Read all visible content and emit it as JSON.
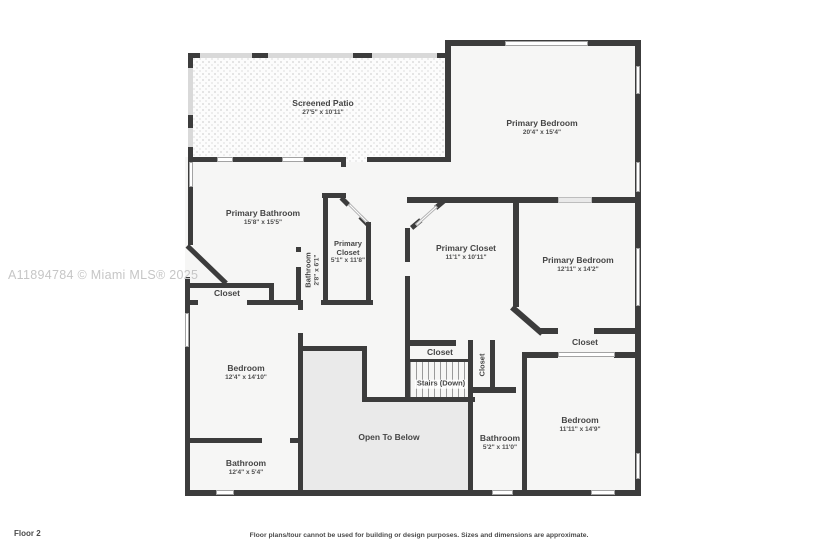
{
  "meta": {
    "watermark": "A11894784 © Miami MLS® 2025",
    "floor_label": "Floor 2",
    "disclaimer": "Floor plans/tour cannot be used for building or design purposes. Sizes and dimensions are approximate."
  },
  "colors": {
    "wall": "#3c3c3c",
    "room_fill": "#f6f6f5",
    "open_to_below_fill": "#eaeaea",
    "screen_wall": "#d9d9d9",
    "label_text": "#454545",
    "watermark_text": "#c6c6c6"
  },
  "rooms": {
    "screened_patio": {
      "name": "Screened Patio",
      "dims": "27'5\" x 10'11\""
    },
    "primary_bedroom_1": {
      "name": "Primary Bedroom",
      "dims": "20'4\" x 15'4\""
    },
    "primary_bathroom": {
      "name": "Primary Bathroom",
      "dims": "15'8\" x 15'5\""
    },
    "bathroom_small": {
      "name": "Bathroom",
      "dims": "2'8\" x 6'1\""
    },
    "primary_closet_small": {
      "name": "Primary Closet",
      "dims": "5'1\" x 11'8\""
    },
    "primary_closet_large": {
      "name": "Primary Closet",
      "dims": "11'1\" x 10'11\""
    },
    "primary_bedroom_2": {
      "name": "Primary Bedroom",
      "dims": "12'11\" x 14'2\""
    },
    "closet_left": {
      "name": "Closet"
    },
    "bedroom_left": {
      "name": "Bedroom",
      "dims": "12'4\" x 14'10\""
    },
    "closet_above_stairs": {
      "name": "Closet"
    },
    "stairs": {
      "name": "Stairs (Down)"
    },
    "closet_hall": {
      "name": "Closet"
    },
    "closet_right": {
      "name": "Closet"
    },
    "open_to_below": {
      "name": "Open To Below"
    },
    "bathroom_center": {
      "name": "Bathroom",
      "dims": "5'2\" x 11'0\""
    },
    "bedroom_right": {
      "name": "Bedroom",
      "dims": "11'11\" x 14'9\""
    },
    "bathroom_bottom": {
      "name": "Bathroom",
      "dims": "12'4\" x 5'4\""
    }
  }
}
